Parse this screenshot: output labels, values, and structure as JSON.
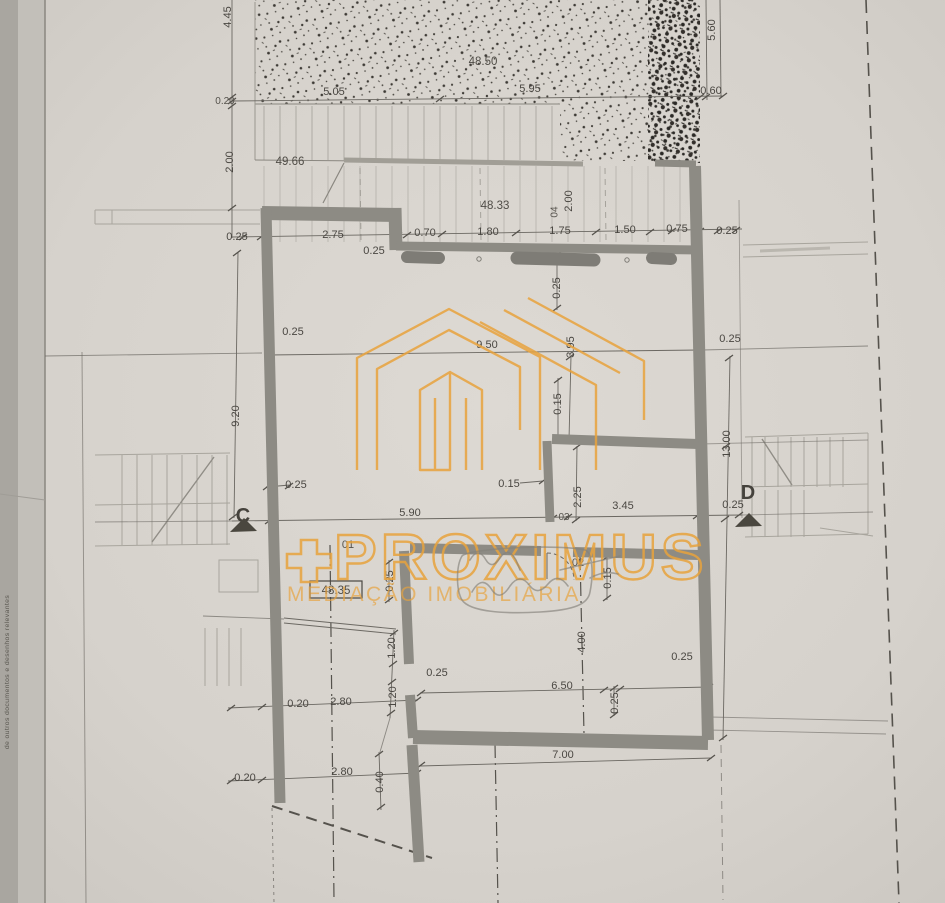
{
  "document": {
    "kind_label": "floor plan drawing",
    "side_text": "de outros documentos e desenhos relevantes"
  },
  "colors": {
    "paper": "#d8d4ce",
    "ink": "#55524c",
    "wall": "#8d8b84",
    "watermark": "#e8a33d"
  },
  "watermark": {
    "plus": "+",
    "title": "PROXIMUS",
    "subtitle": "MEDIAÇÃO IMOBILIÁRIA"
  },
  "markers": {
    "c": "C",
    "d": "D"
  },
  "dims": [
    "4.45",
    "48.50",
    "5.60",
    "5.05",
    "5.95",
    "0.60",
    "0.20",
    "2.00",
    "49.66",
    "48.33",
    "04",
    "2.00",
    "0.25",
    "2.75",
    "0.70",
    "1.80",
    "1.75",
    "1.50",
    "0.75",
    "0.25",
    "0.25",
    "0.25",
    "0.25",
    "0.25",
    "9.50",
    "3.95",
    "9.20",
    "0.15",
    "13.00",
    "0.15",
    "2.25",
    "5.90",
    "03",
    "3.45",
    "0.25",
    "0.25",
    "01",
    "02",
    "48.35",
    "0.25",
    "0.15",
    "1.20",
    "0.25",
    "1.20",
    "4.00",
    "0.25",
    "6.50",
    "0.25",
    "0.20",
    "2.80",
    "7.00",
    "0.20",
    "2.80",
    "0.40"
  ]
}
